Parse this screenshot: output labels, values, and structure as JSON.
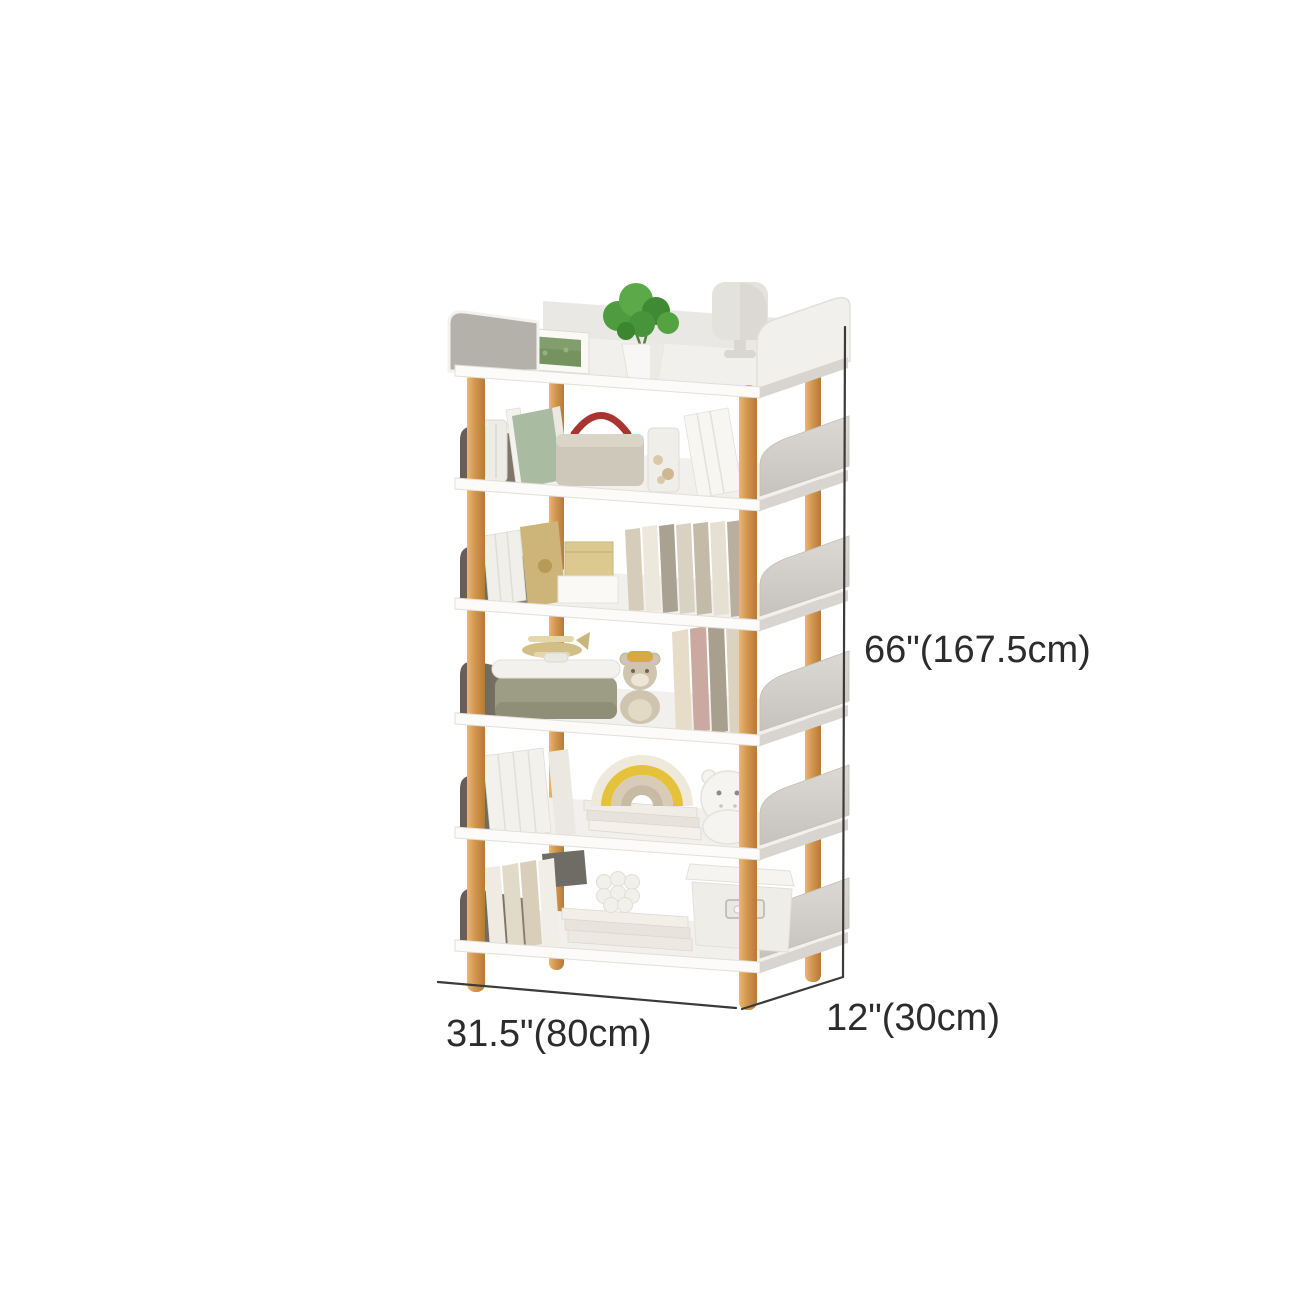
{
  "page": {
    "background_color": "#ffffff",
    "type": "product-dimension-diagram"
  },
  "product": {
    "name": "6-tier freestanding bookshelf",
    "dimensions": {
      "height": "66\"(167.5cm)",
      "width": "31.5\"(80cm)",
      "depth": "12\"(30cm)"
    },
    "colors": {
      "shelf_white": "#fcfbf9",
      "shelf_surface": "#f2f0ec",
      "side_panel_gray": "#d0cdc8",
      "dark_bookend": "#6f675d",
      "wood_post": "#d2964e",
      "dimension_line": "#3a3a3a",
      "label_text": "#2c2c2c",
      "plant_green": "#4f9c3e",
      "basket_handle_red": "#a93531"
    },
    "shelf_count": 6,
    "decor_items": [
      "photo-frame",
      "potted-plant",
      "table-lamp",
      "glass-jar",
      "green-book",
      "storage-basket",
      "shell-jar",
      "white-books",
      "gold-book",
      "gift-box",
      "book-row",
      "toy-plane",
      "storage-case",
      "teddy-bear",
      "rainbow-stacker",
      "hippo-plush",
      "book-stack",
      "bubble-candle",
      "storage-box"
    ]
  }
}
